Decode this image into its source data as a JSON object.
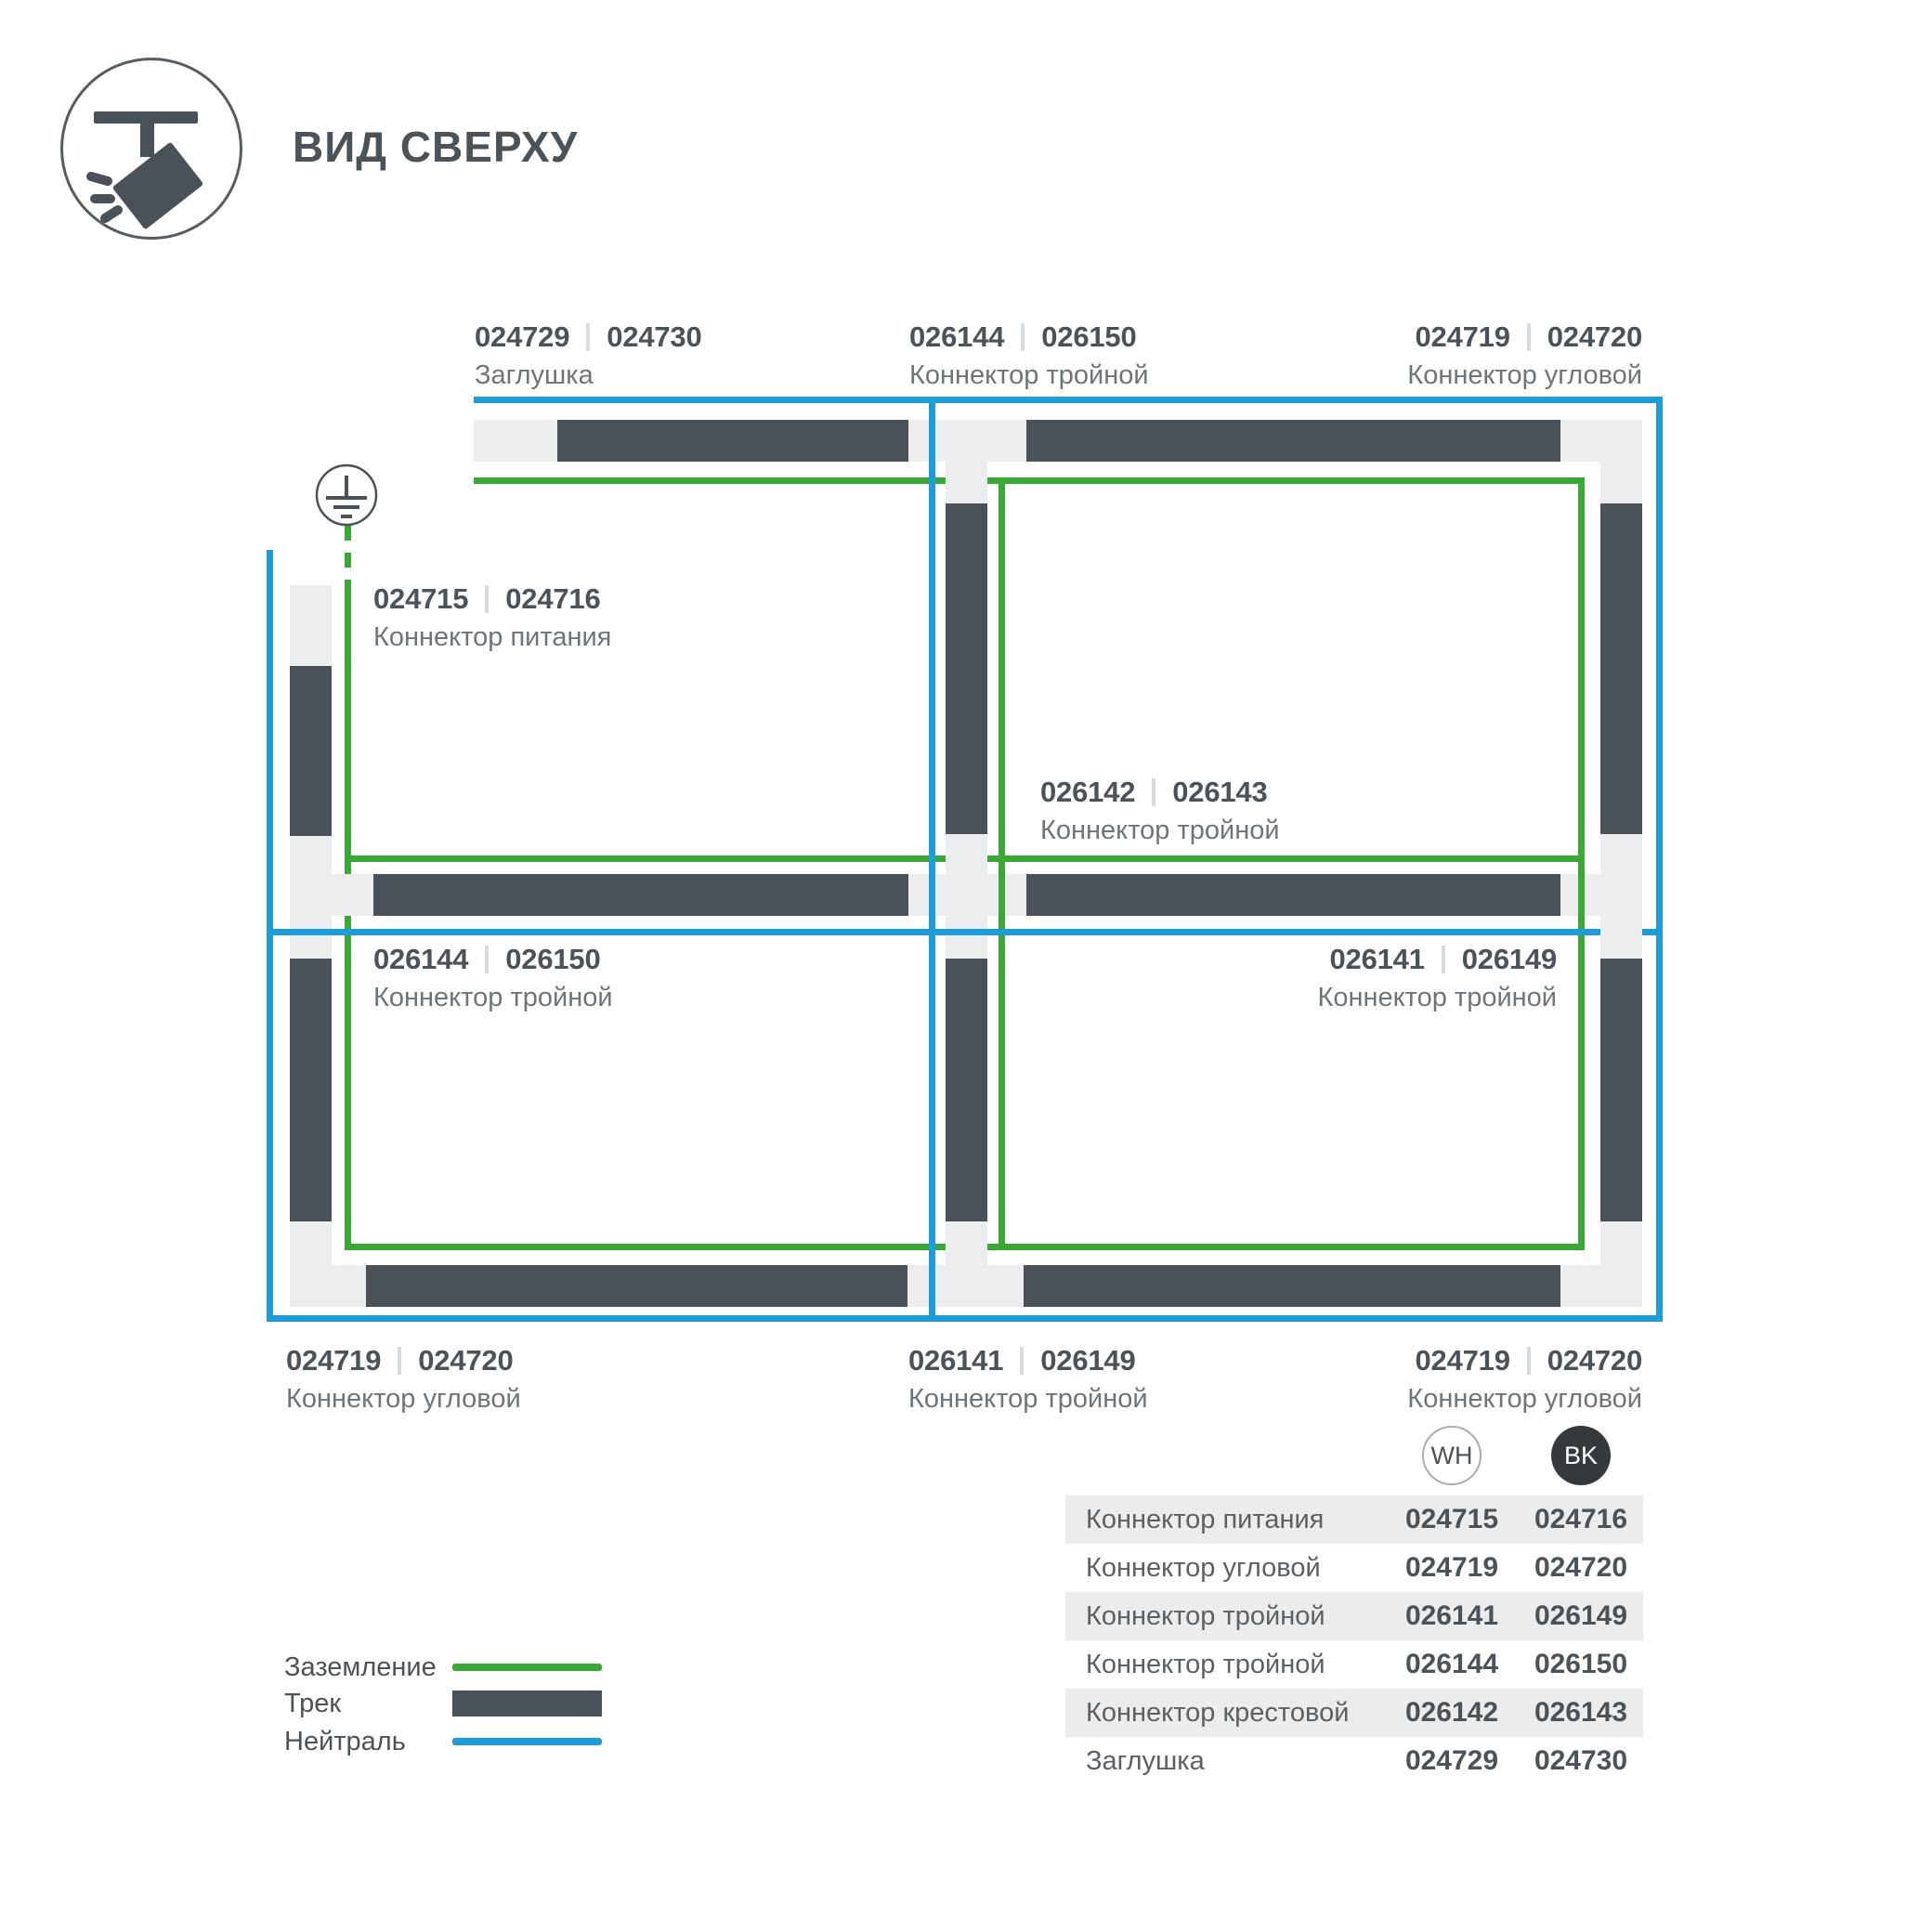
{
  "header": {
    "title": "ВИД СВЕРХУ"
  },
  "colors": {
    "track": "#4a5158",
    "connector": "#ebedee",
    "ground_green": "#3aa835",
    "neutral_blue": "#1e9cd7"
  },
  "diagram_labels": [
    {
      "code_wh": "024729",
      "code_bk": "024730",
      "name": "Заглушка"
    },
    {
      "code_wh": "026144",
      "code_bk": "026150",
      "name": "Коннектор тройной"
    },
    {
      "code_wh": "024719",
      "code_bk": "024720",
      "name": "Коннектор угловой"
    },
    {
      "code_wh": "024715",
      "code_bk": "024716",
      "name": "Коннектор питания"
    },
    {
      "code_wh": "026142",
      "code_bk": "026143",
      "name": "Коннектор тройной"
    },
    {
      "code_wh": "026144",
      "code_bk": "026150",
      "name": "Коннектор тройной"
    },
    {
      "code_wh": "026141",
      "code_bk": "026149",
      "name": "Коннектор тройной"
    },
    {
      "code_wh": "024719",
      "code_bk": "024720",
      "name": "Коннектор угловой"
    },
    {
      "code_wh": "026141",
      "code_bk": "026149",
      "name": "Коннектор тройной"
    },
    {
      "code_wh": "024719",
      "code_bk": "024720",
      "name": "Коннектор угловой"
    }
  ],
  "legend": {
    "items": [
      {
        "label": "Заземление"
      },
      {
        "label": "Трек"
      },
      {
        "label": "Нейтраль"
      }
    ]
  },
  "table": {
    "col_wh": "WH",
    "col_bk": "BK",
    "rows": [
      {
        "name": "Коннектор питания",
        "wh": "024715",
        "bk": "024716"
      },
      {
        "name": "Коннектор угловой",
        "wh": "024719",
        "bk": "024720"
      },
      {
        "name": "Коннектор тройной",
        "wh": "026141",
        "bk": "026149"
      },
      {
        "name": "Коннектор тройной",
        "wh": "026144",
        "bk": "026150"
      },
      {
        "name": "Коннектор крестовой",
        "wh": "026142",
        "bk": "026143"
      },
      {
        "name": "Заглушка",
        "wh": "024729",
        "bk": "024730"
      }
    ]
  }
}
